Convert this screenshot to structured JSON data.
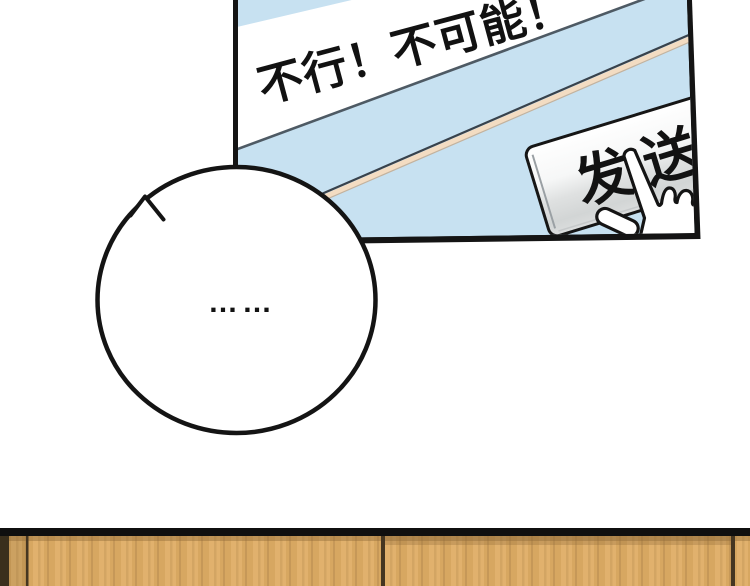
{
  "panel": {
    "chat_message": "不行！不可能！",
    "send_button_label": "发送"
  },
  "speech_bubble": {
    "ellipsis": "……"
  },
  "colors": {
    "screen_blue": "#c7e1f1",
    "band_white": "#ffffff",
    "band_shadow": "#4e5a64",
    "stripe_beige": "#f3dcc2",
    "stripe_dark_edge": "#38424c",
    "outline_black": "#141414",
    "button_top": "#ffffff",
    "button_gray": "#d2d5d5",
    "wood_tan": "#dfad65",
    "wood_separator": "#453621"
  }
}
